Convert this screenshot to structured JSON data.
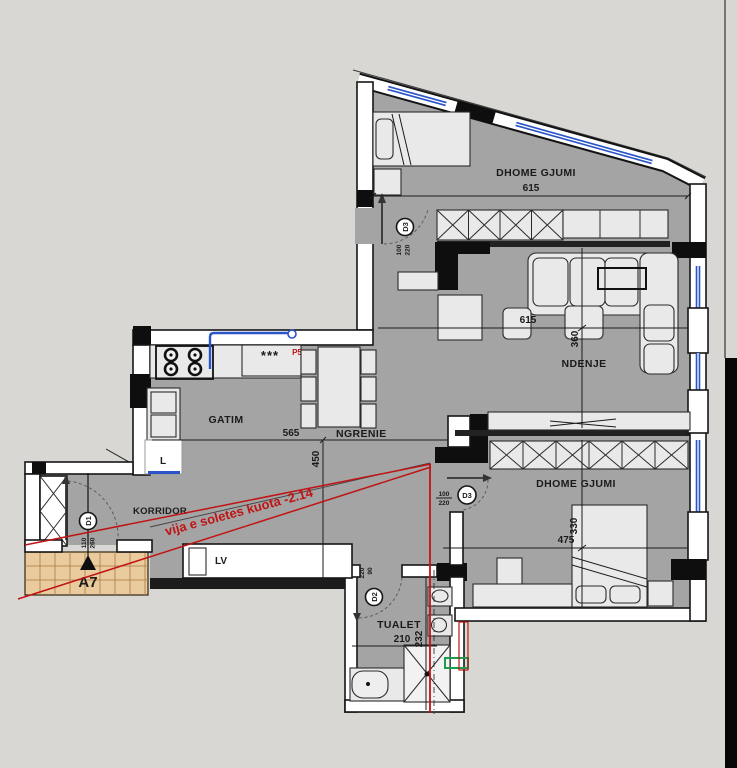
{
  "colors": {
    "bg": "#d8d7d4",
    "floor": "#a4a4a4",
    "wall_dark": "#141414",
    "win": "#2a55c8",
    "red": "#c01414",
    "tile": "#eacb9e",
    "tgrid": "#a87a40",
    "green": "#1e9e4c",
    "dim": "#1b1b1b"
  },
  "rooms": {
    "bedroom_top": {
      "label": "DHOME GJUMI",
      "width": "615"
    },
    "living": {
      "label": "NDENJE",
      "width": "615",
      "depth": "360"
    },
    "bedroom_bottom": {
      "label": "DHOME GJUMI",
      "width": "475",
      "depth": "330"
    },
    "kitchen": {
      "label": "GATIM"
    },
    "dining": {
      "label": "NGRENIE",
      "width": "565",
      "depth": "450"
    },
    "corridor": {
      "label": "KORRIDOR"
    },
    "toilet": {
      "label": "TUALET",
      "width": "210",
      "depth": "232"
    }
  },
  "doors": {
    "d1": {
      "tag": "D1",
      "dims": [
        "110",
        "260"
      ]
    },
    "d2": {
      "tag": "D2",
      "dims": [
        "220",
        "90"
      ]
    },
    "d3_top": {
      "tag": "D3",
      "dims": [
        "100",
        "220"
      ]
    },
    "d3_bottom": {
      "tag": "D3",
      "dims": [
        "100",
        "220"
      ]
    }
  },
  "labels": {
    "shaft": "L",
    "washing_machine": "LV",
    "section_marker": "A7",
    "p5": "P5",
    "freezer_stars": "***"
  },
  "annotations": {
    "slab_note": "vija e soletes kuota -2.14"
  }
}
